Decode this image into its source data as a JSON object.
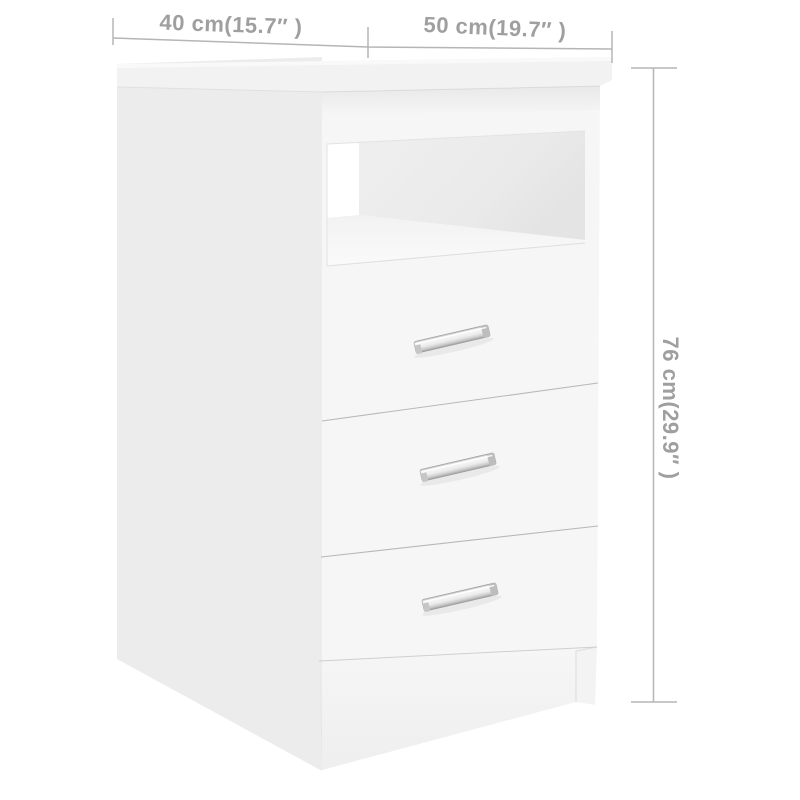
{
  "figure": {
    "subject": "white cabinet with open compartment and three drawers",
    "style": "product dimension diagram",
    "drawer_count": 3,
    "handle_finish": "chrome"
  },
  "dimensions": {
    "width_label": "40 cm(15.7″ )",
    "depth_label": "50 cm(19.7″ )",
    "height_label": "76 cm(29.9″ )"
  },
  "colors": {
    "background": "#ffffff",
    "annotation_text": "#9f9f9f",
    "annotation_line": "#b5b5b5",
    "side_panel": "#ececec",
    "front_panel": "#f6f6f6",
    "top_panel": "#f2f2f2",
    "compartment_back": "#eaeaea",
    "compartment_inner_wall": "#ffffff",
    "handle_chrome": "#dcdcdc"
  }
}
